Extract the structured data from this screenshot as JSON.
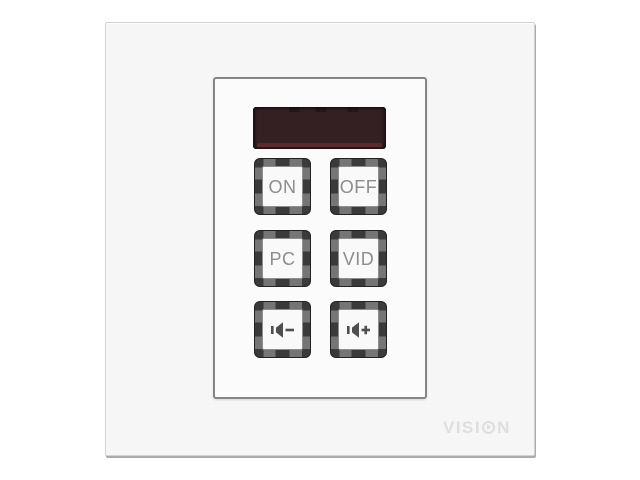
{
  "display": {
    "text": "",
    "state": "off"
  },
  "keypad": {
    "buttons": [
      {
        "id": "on",
        "label": "ON",
        "kind": "text"
      },
      {
        "id": "off",
        "label": "OFF",
        "kind": "text"
      },
      {
        "id": "pc",
        "label": "PC",
        "kind": "text"
      },
      {
        "id": "vid",
        "label": "VID",
        "kind": "text"
      },
      {
        "id": "volume-down",
        "label": "",
        "kind": "icon",
        "icon": "speaker-minus-icon"
      },
      {
        "id": "volume-up",
        "label": "",
        "kind": "icon",
        "icon": "speaker-plus-icon"
      }
    ]
  },
  "brand": {
    "text": "VISION",
    "part1": "VISI",
    "part2": "N"
  },
  "colors": {
    "faceplate": "#f6f6f6",
    "panel": "#fbfbfb",
    "panel_border": "#858585",
    "display_bg": "#341f22",
    "display_glow": "#5a2a2e",
    "button_frame": "#3a3a3a",
    "button_cap": "#f9f9f9",
    "button_label": "#8c8c8c",
    "icon": "#4f4f4f",
    "brand": "#dedede"
  }
}
